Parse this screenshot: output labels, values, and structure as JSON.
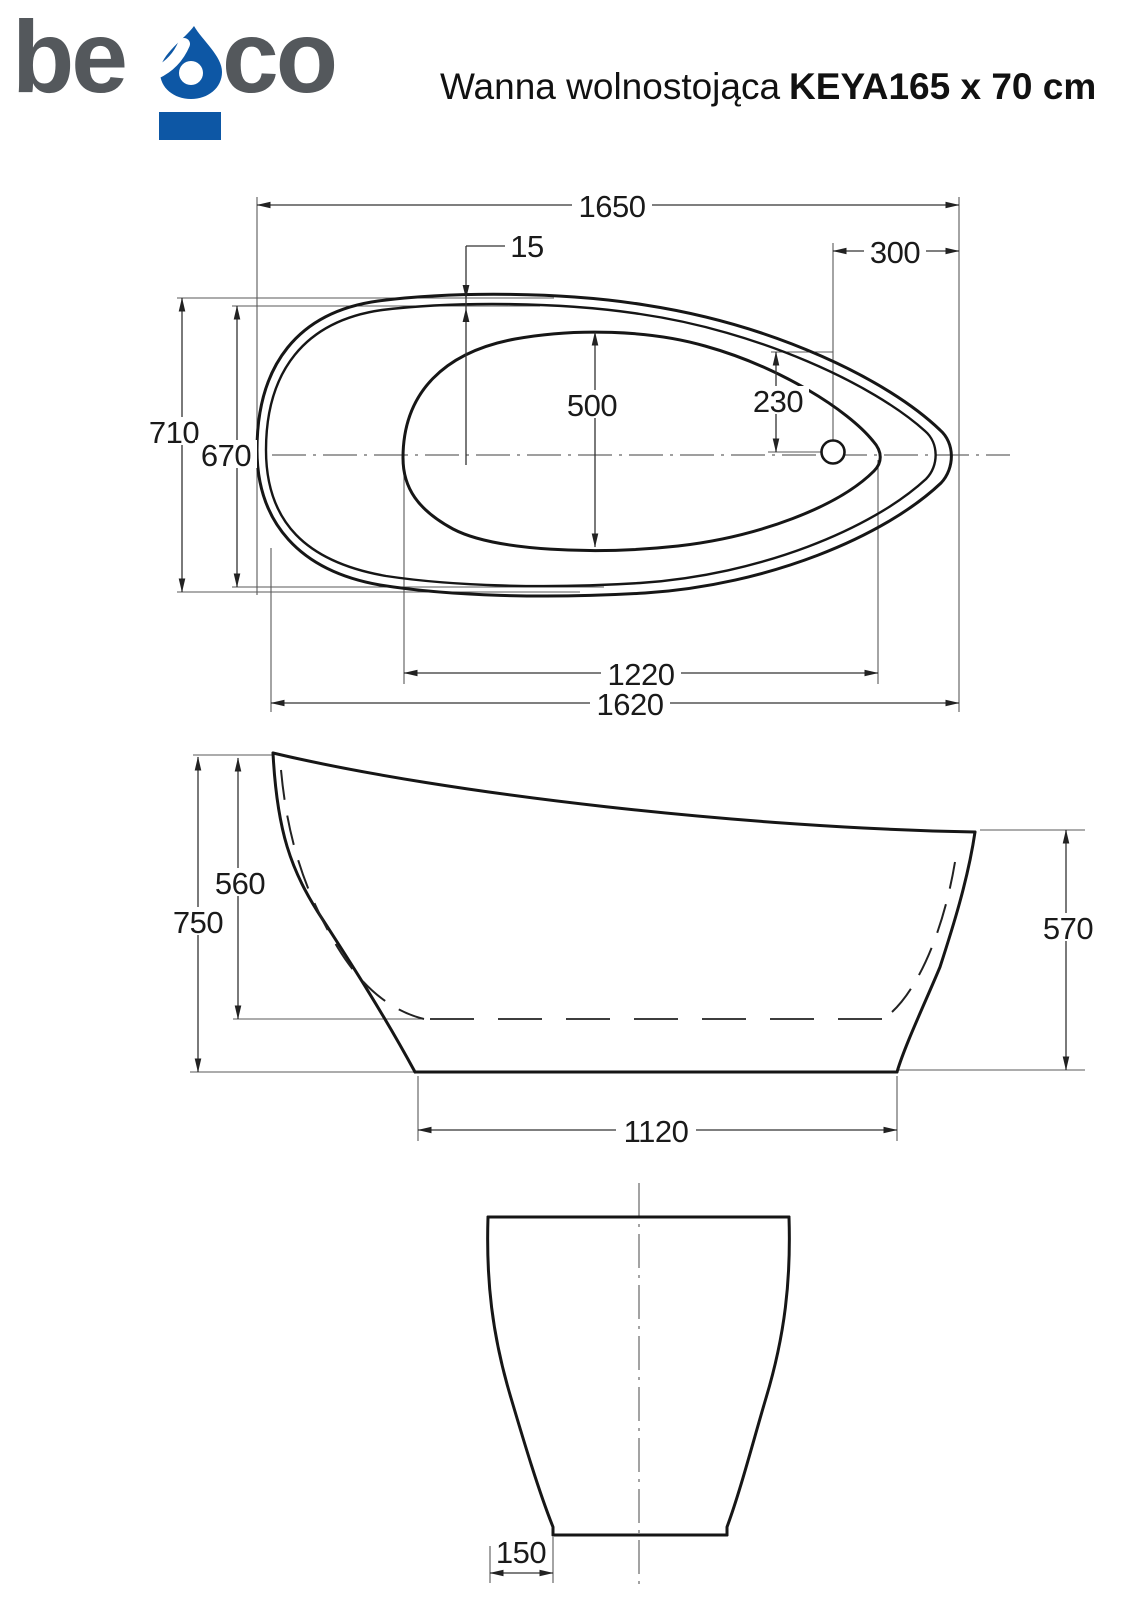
{
  "header": {
    "logo": {
      "text_left": "be",
      "text_right": "co",
      "drop_icon": "water-drop-icon",
      "gray": "#54585c",
      "blue": "#0d57a5"
    },
    "title": {
      "regular": "Wanna wolnostojąca",
      "bold": "KEYA165 x 70 cm"
    }
  },
  "drawing": {
    "line_color": "#161616",
    "dims": {
      "d1650": "1650",
      "d15": "15",
      "d300": "300",
      "d710": "710",
      "d670": "670",
      "d500": "500",
      "d230": "230",
      "d1220": "1220",
      "d1620": "1620",
      "d560": "560",
      "d750": "750",
      "d570": "570",
      "d1120": "1120",
      "d150": "150"
    }
  }
}
